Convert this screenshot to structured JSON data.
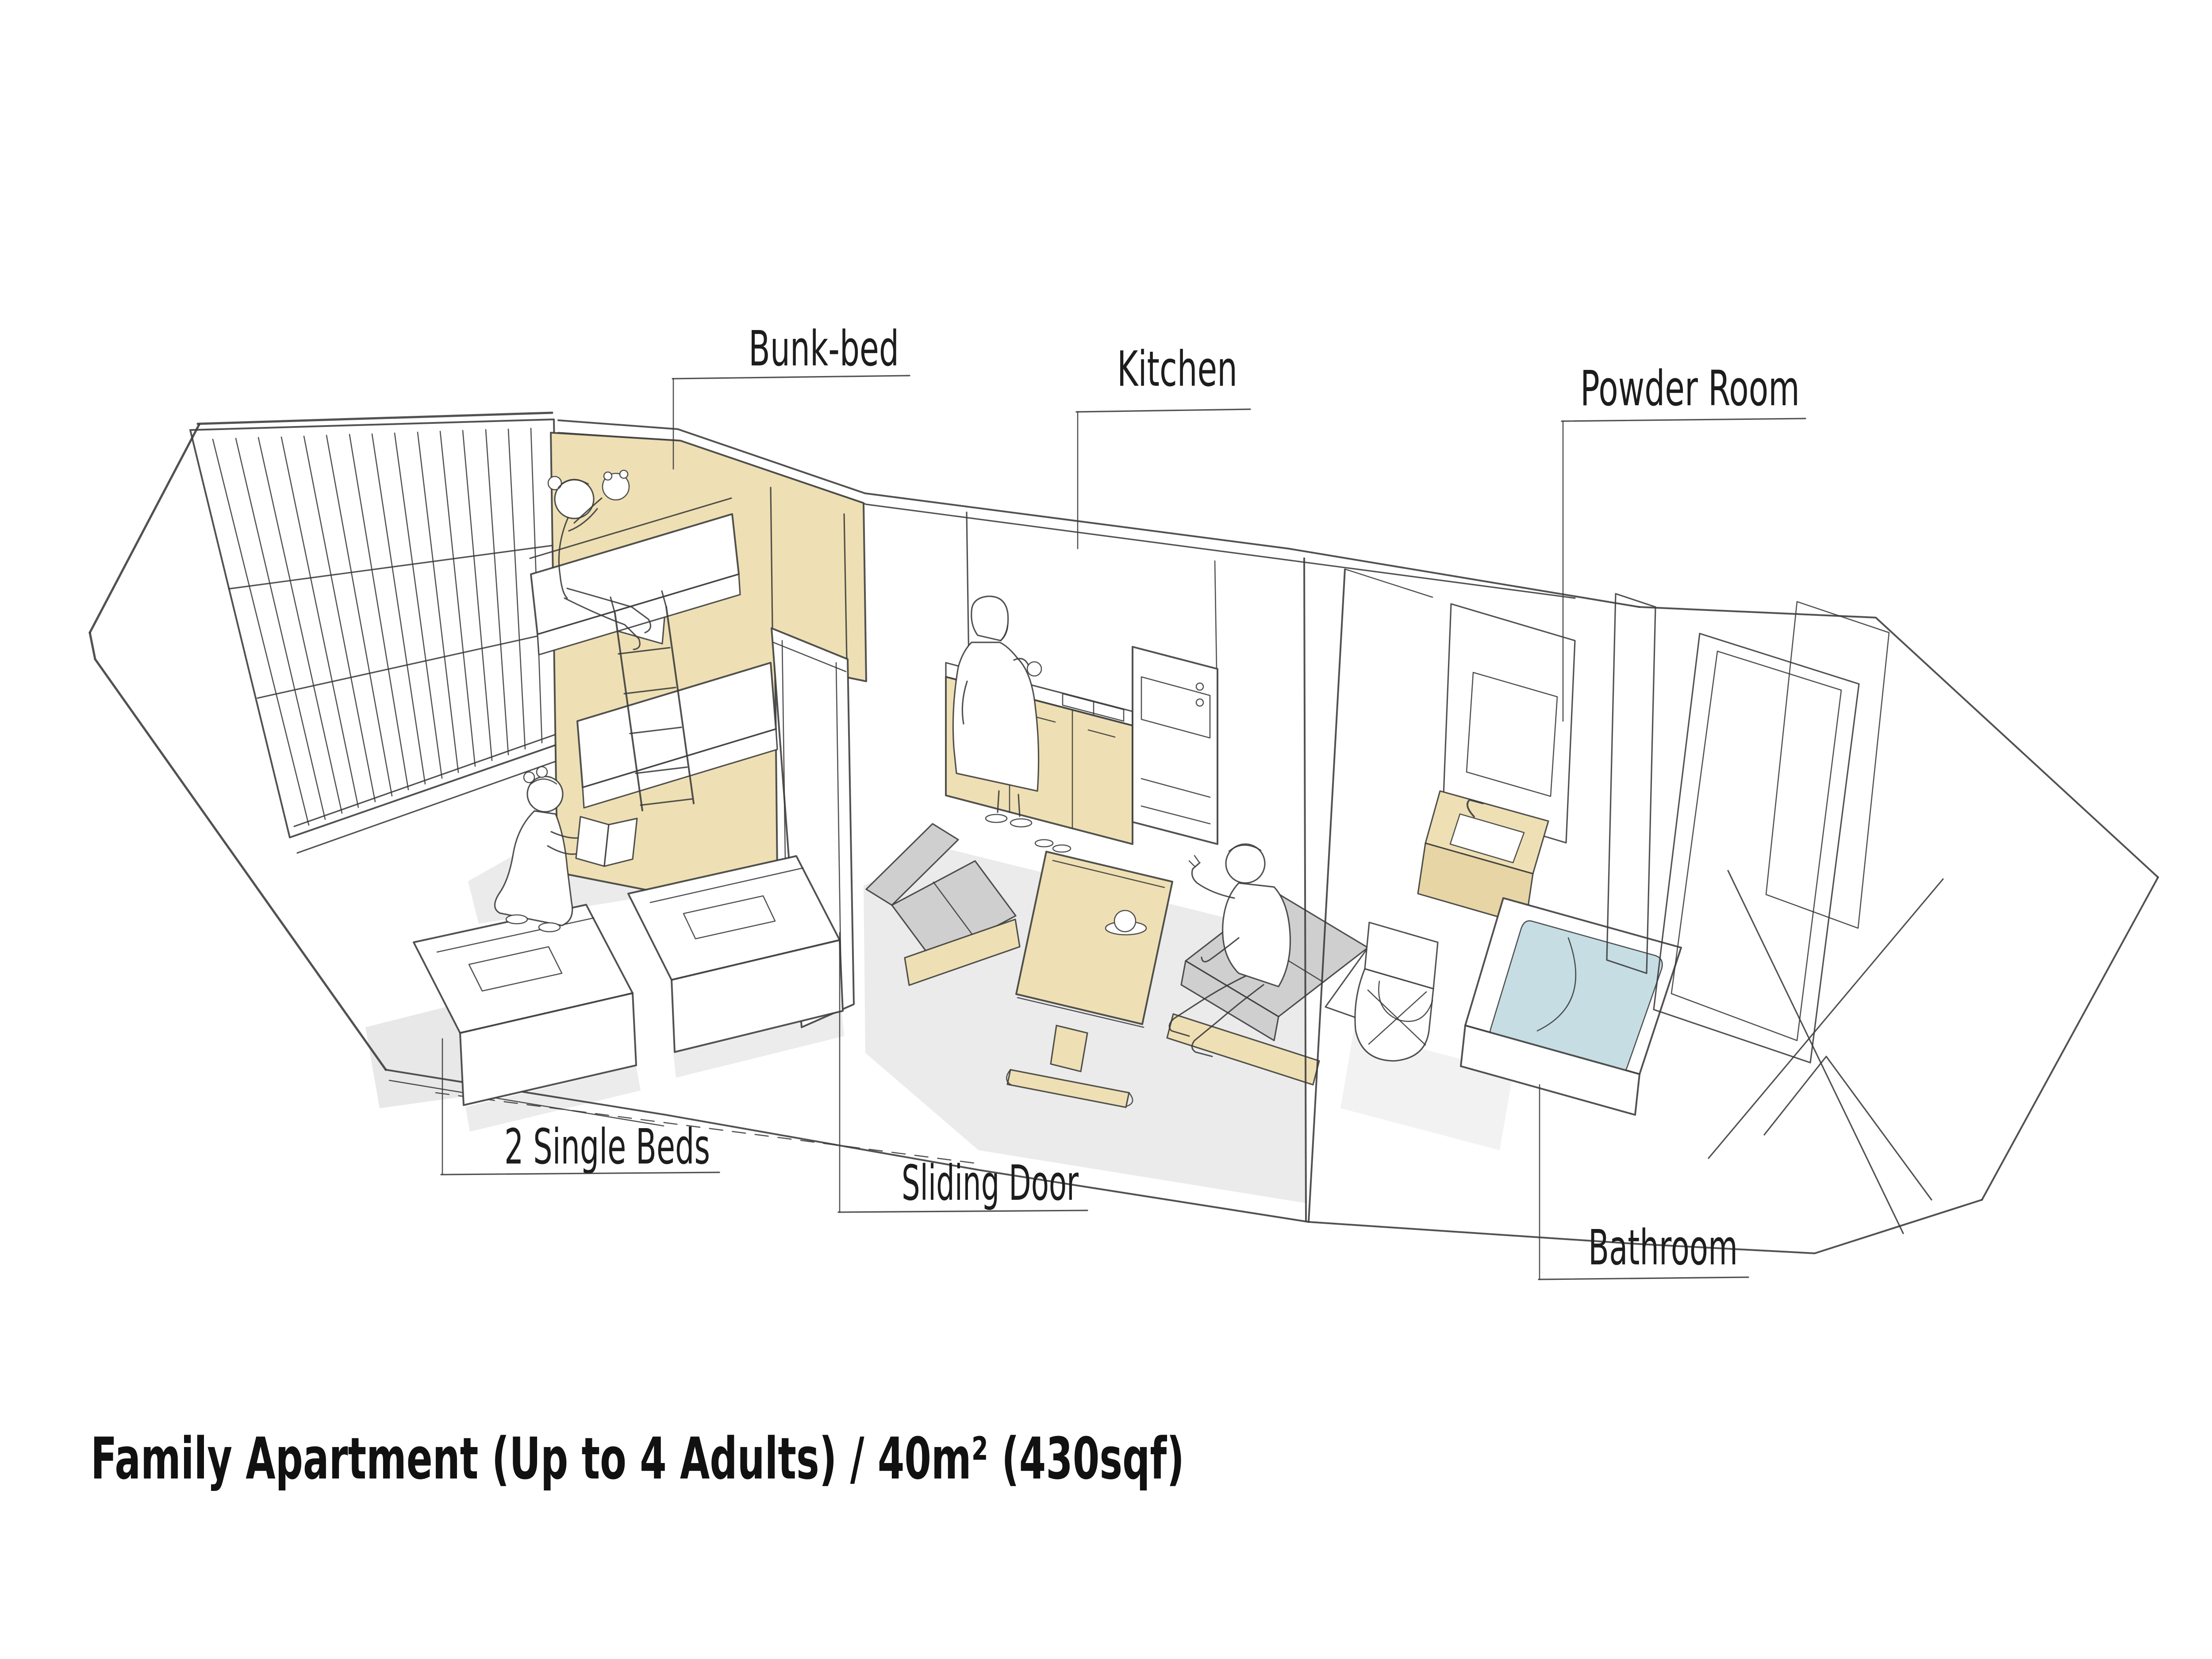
{
  "title": "Family Apartment (Up to 4 Adults) / 40m² (430sqf)",
  "labels": {
    "bunk_bed": "Bunk-bed",
    "kitchen": "Kitchen",
    "powder_room": "Powder Room",
    "single_beds": "2 Single Beds",
    "sliding_door": "Sliding Door",
    "bathroom": "Bathroom"
  },
  "palette": {
    "line": "#3a3a3a",
    "wood": "#eee0b4",
    "wood_dark": "#e7d5a5",
    "water_blue": "#c6dde3",
    "floor_gray": "#e6e6e6",
    "cushion_gray": "#cfcfcf",
    "paper": "#ffffff"
  },
  "figures": [
    {
      "name": "child-on-bunk-bed"
    },
    {
      "name": "girl-reading-on-floor"
    },
    {
      "name": "woman-at-kitchen-counter"
    },
    {
      "name": "man-seated-at-dining-table"
    }
  ]
}
